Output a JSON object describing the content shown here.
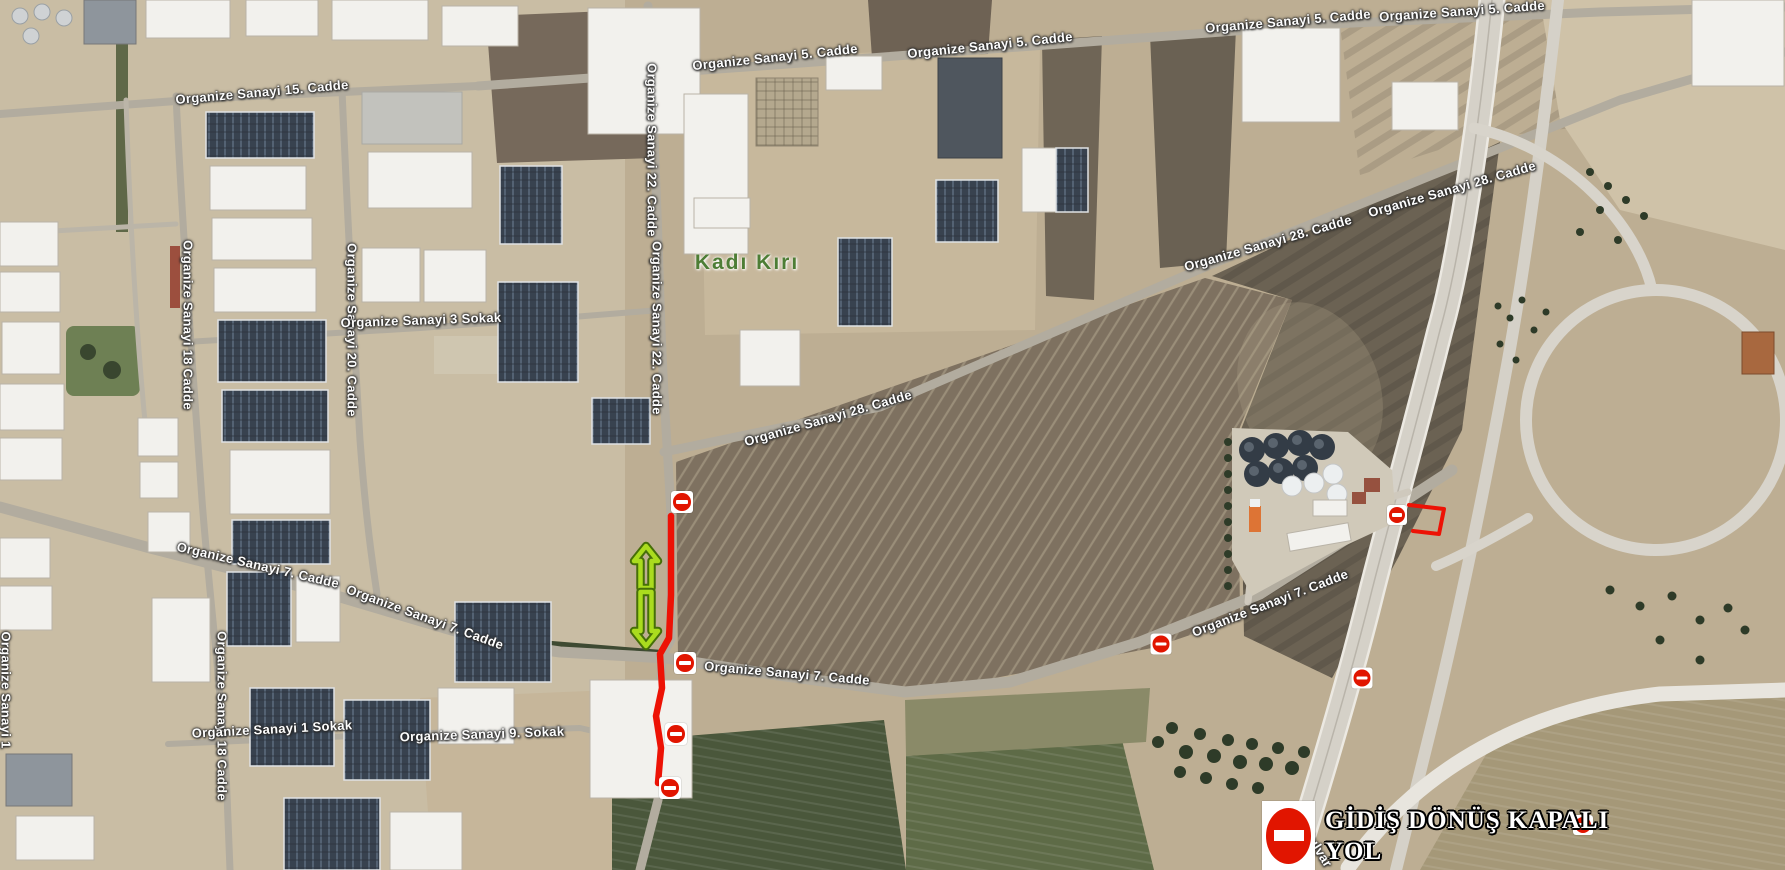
{
  "map_labels": [
    {
      "text": "Organize Sanayi 15. Cadde",
      "x": 262,
      "y": 92,
      "angle": -5
    },
    {
      "text": "Organize Sanayi 5. Cadde",
      "x": 775,
      "y": 57,
      "angle": -6
    },
    {
      "text": "Organize Sanayi 5. Cadde",
      "x": 990,
      "y": 45,
      "angle": -6
    },
    {
      "text": "Organize Sanayi 5. Cadde",
      "x": 1288,
      "y": 21,
      "angle": -5
    },
    {
      "text": "Organize Sanayi 5. Cadde",
      "x": 1462,
      "y": 11,
      "angle": -4
    },
    {
      "text": "Organize Sanayi 22. Cadde",
      "x": 652,
      "y": 150,
      "angle": 90
    },
    {
      "text": "Organize Sanayi 22. Cadde",
      "x": 657,
      "y": 328,
      "angle": 90
    },
    {
      "text": "Organize Sanayi 18 Cadde",
      "x": 188,
      "y": 325,
      "angle": 90
    },
    {
      "text": "Organize Sanayi 20. Cadde",
      "x": 352,
      "y": 330,
      "angle": 90
    },
    {
      "text": "Organize Sanayi 18 Cadde",
      "x": 222,
      "y": 716,
      "angle": 90
    },
    {
      "text": "Organize Sanayi 3 Sokak",
      "x": 421,
      "y": 320,
      "angle": -2
    },
    {
      "text": "Organize Sanayi 28. Cadde",
      "x": 828,
      "y": 418,
      "angle": -16
    },
    {
      "text": "Organize Sanayi 28. Cadde",
      "x": 1268,
      "y": 243,
      "angle": -16
    },
    {
      "text": "Organize Sanayi 28. Cadde",
      "x": 1452,
      "y": 189,
      "angle": -16
    },
    {
      "text": "Organize Sanayi 7. Cadde",
      "x": 258,
      "y": 565,
      "angle": 13
    },
    {
      "text": "Organize Sanayi 7. Cadde",
      "x": 425,
      "y": 617,
      "angle": 20
    },
    {
      "text": "Organize Sanayi 7. Cadde",
      "x": 787,
      "y": 673,
      "angle": 5
    },
    {
      "text": "Organize Sanayi 7. Cadde",
      "x": 1270,
      "y": 603,
      "angle": -21
    },
    {
      "text": "Organize Sanayi 1 Sokak",
      "x": 272,
      "y": 729,
      "angle": -3
    },
    {
      "text": "Organize Sanayi 9. Sokak",
      "x": 482,
      "y": 734,
      "angle": -2
    },
    {
      "text": "Organize Sanayi 1",
      "x": 6,
      "y": 690,
      "angle": 90
    },
    {
      "text": "Bulvar",
      "x": 1318,
      "y": 848,
      "angle": 58
    },
    {
      "text": "Kadı Kırı",
      "x": 747,
      "y": 263,
      "angle": 0,
      "kind": "place"
    }
  ],
  "no_entry_markers": [
    {
      "x": 682,
      "y": 502,
      "size": 22
    },
    {
      "x": 685,
      "y": 663,
      "size": 22
    },
    {
      "x": 676,
      "y": 734,
      "size": 22
    },
    {
      "x": 670,
      "y": 788,
      "size": 22
    },
    {
      "x": 1161,
      "y": 644,
      "size": 21
    },
    {
      "x": 1362,
      "y": 678,
      "size": 21
    },
    {
      "x": 1397,
      "y": 515,
      "size": 20
    },
    {
      "x": 1583,
      "y": 825,
      "size": 20
    }
  ],
  "closed_route": {
    "points": "671,516 671,595 669,638 660,654 662,688 656,716 661,748 658,783",
    "width": 6.5
  },
  "junction_shape": {
    "points": "1409,505 1444,509 1439,534 1413,531",
    "width": 4
  },
  "direction_arrows": [
    {
      "x": 646,
      "tail_y": 588,
      "tip_y": 546
    },
    {
      "x": 646,
      "tail_y": 592,
      "tip_y": 646
    }
  ],
  "legend": {
    "line1": "GİDİŞ DÖNÜŞ KAPALI",
    "line2": "YOL",
    "icon": "no-entry-icon"
  },
  "colors": {
    "closed_route_red": "#ed1205",
    "no_entry_red": "#e11500",
    "arrow_green": "#aadc1e",
    "arrow_outline": "#466f08",
    "place_label_green": "#4d7d35",
    "road_label_white": "#fdfdfd"
  }
}
